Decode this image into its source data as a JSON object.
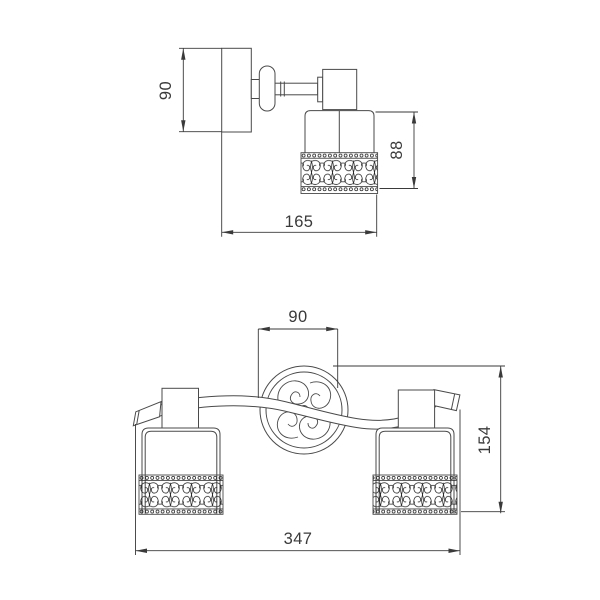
{
  "sheet": {
    "background": "#ffffff",
    "line_color": "#4a4a4a",
    "dim_color": "#3a3a3a"
  },
  "views": {
    "single": {
      "height": "90",
      "width": "165",
      "shade_height": "88"
    },
    "double": {
      "canopy_width": "90",
      "height": "154",
      "width": "347"
    }
  }
}
